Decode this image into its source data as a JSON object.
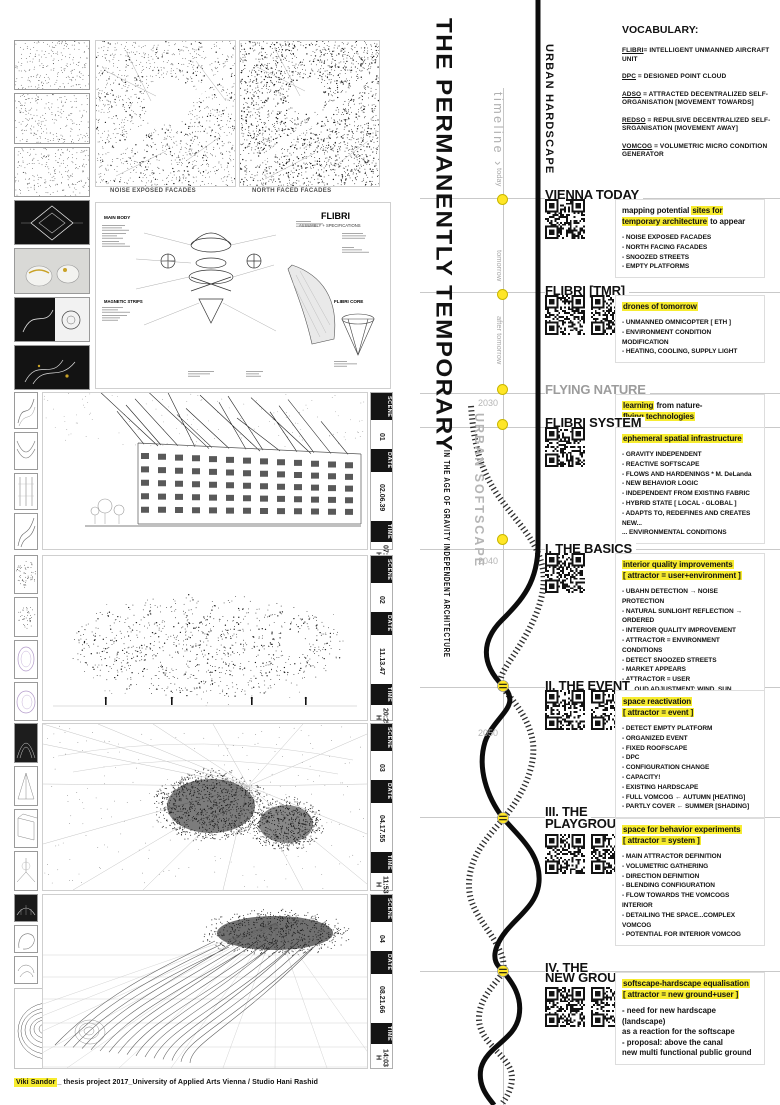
{
  "title": {
    "main": "THE PERMANENTLY TEMPORARY",
    "subtitle": "IN THE AGE OF GRAVITY INDEPENDENT ARCHITECTURE"
  },
  "timeline": {
    "label": "timeline",
    "arrow": "›",
    "hardscape": "URBAN HARDSCAPE",
    "softscape": "URBAN SOFTSCAPE",
    "tick_today": "today",
    "tick_tomorrow": "tomorrow",
    "tick_after": "after tomorrow",
    "year_2030": "2030",
    "year_2040": "2040",
    "year_2050": "2050"
  },
  "vocabulary": {
    "heading": "VOCABULARY:",
    "entries": [
      {
        "term": "FLIBRI",
        "def": "= INTELLIGENT UNMANNED AIRCRAFT UNIT"
      },
      {
        "term": "DPC",
        "def": " = DESIGNED POINT CLOUD"
      },
      {
        "term": "ADSO",
        "def": " = ATTRACTED DECENTRALIZED SELF-ORGANISATION [MOVEMENT TOWARDS]"
      },
      {
        "term": "REDSO",
        "def": " = REPULSIVE DECENTRALIZED SELF-SRGANISATION [MOVEMENT AWAY]"
      },
      {
        "term": "VOMCOG",
        "def": " = VOLUMETRIC MICRO CONDITION GENERATOR"
      }
    ]
  },
  "maps": {
    "label_left": "NOISE EXPOSED FACADES",
    "label_right": "NORTH FACED FACADES"
  },
  "flibri_diagram": {
    "title": "FLIBRI",
    "subtitle": "ASSEMBLY + SPECIFICATIONS",
    "label_main_body": "MAIN BODY",
    "label_magnetic": "MAGNETIC STRIPS",
    "label_core": "FLIBRI CORE"
  },
  "scenes": [
    {
      "scene_label": "SCENE",
      "scene": "01",
      "date_label": "DATE",
      "date": "02.06.39",
      "time_label": "TIME",
      "time": "07:10 H"
    },
    {
      "scene_label": "SCENE",
      "scene": "02",
      "date_label": "DATE",
      "date": "11.13.47",
      "time_label": "TIME",
      "time": "20:25 H"
    },
    {
      "scene_label": "SCENE",
      "scene": "03",
      "date_label": "DATE",
      "date": "04.17.55",
      "time_label": "TIME",
      "time": "11:53 H"
    },
    {
      "scene_label": "SCENE",
      "scene": "04",
      "date_label": "DATE",
      "date": "08.21.66",
      "time_label": "TIME",
      "time": "14:03 H"
    }
  ],
  "sections": [
    {
      "heading": "VIENNA TODAY",
      "qr_count": 1,
      "intro": [
        [
          {
            "t": "mapping potential ",
            "h": 0
          },
          {
            "t": "sites for temporary architecture",
            "h": 1
          },
          {
            "t": " to appear",
            "h": 0
          }
        ]
      ],
      "bullets": [
        "- NOISE EXPOSED FACADES",
        "- NORTH FACING FACADES",
        "- SNOOZED STREETS",
        "- EMPTY PLATFORMS"
      ]
    },
    {
      "heading": "FLIBRI [TMR]",
      "qr_count": 2,
      "intro": [
        [
          {
            "t": "drones of tomorrow",
            "h": 1
          }
        ]
      ],
      "bullets": [
        "- UNMANNED OMNICOPTER [ ETH ]",
        "- ENVIRONMENT CONDITION MODIFICATION",
        "- HEATING, COOLING, SUPPLY LIGHT"
      ]
    },
    {
      "heading": "FLYING NATURE",
      "gray": true,
      "qr_count": 0,
      "intro": [
        [
          {
            "t": "learning",
            "h": 1
          },
          {
            "t": " from nature-",
            "h": 0
          }
        ],
        [
          {
            "t": "flying technologies",
            "h": 1
          }
        ]
      ],
      "bullets": []
    },
    {
      "heading": "FLIBRI SYSTEM",
      "qr_count": 1,
      "intro": [
        [
          {
            "t": "ephemeral spatial infrastructure",
            "h": 1
          }
        ]
      ],
      "bullets": [
        "- GRAVITY INDEPENDENT",
        "- REACTIVE SOFTSCAPE",
        "- FLOWS AND HARDENINGS * M. DeLanda",
        "- NEW BEHAVIOR LOGIC",
        "- INDEPENDENT FROM EXISTING FABRIC",
        "- HYBRID STATE [ LOCAL - GLOBAL ]",
        "- ADAPTS TO, REDEFINES AND CREATES NEW...",
        "... ENVIRONMENTAL CONDITIONS"
      ]
    },
    {
      "heading": "I. THE BASICS",
      "qr_count": 1,
      "intro": [
        [
          {
            "t": "interior quality improvements",
            "h": 1
          }
        ],
        [
          {
            "t": "[ attractor = user+environment ]",
            "h": 1
          }
        ]
      ],
      "bullets": [
        "- UBAHN DETECTION → NOISE PROTECTION",
        "- NATURAL SUNLIGHT REFLECTION → ORDERED",
        "- INTERIOR QUALITY IMPROVEMENT",
        "- ATTRACTOR = ENVIRONMENT CONDITIONS",
        "- DETECT SNOOZED STREETS",
        "- MARKET APPEARS",
        "- ATTRACTOR = USER",
        "- CLOUD ADJUSTMENT: WIND, SUN"
      ]
    },
    {
      "heading": "II. THE EVENT",
      "qr_count": 2,
      "intro": [
        [
          {
            "t": "space reactivation",
            "h": 1
          }
        ],
        [
          {
            "t": "[ attractor = event ]",
            "h": 1
          }
        ]
      ],
      "bullets": [
        "- DETECT EMPTY PLATFORM",
        "- ORGANIZED EVENT",
        "- FIXED ROOFSCAPE",
        "- DPC",
        "- CONFIGURATION CHANGE",
        "- CAPACITY!",
        "- EXISTING HARDSCAPE",
        "- FULL VOMCOG ← AUTUMN [HEATING]",
        "- PARTLY COVER ← SUMMER [SHADING]"
      ]
    },
    {
      "heading": "III. THE",
      "heading2": "PLAYGROUND",
      "qr_count": 2,
      "intro": [
        [
          {
            "t": "space for behavior experiments",
            "h": 1
          }
        ],
        [
          {
            "t": "[ attractor = system ]",
            "h": 1
          }
        ]
      ],
      "bullets": [
        "- MAIN ATTRACTOR DEFINITION",
        "- VOLUMETRIC GATHERING",
        "- DIRECTION DEFINITION",
        "- BLENDING CONFIGURATION",
        "- FLOW TOWARDS THE VOMCOGS INTERIOR",
        "- DETAILING THE SPACE...COMPLEX VOMCOG",
        "- POTENTIAL FOR INTERIOR VOMCOG"
      ]
    },
    {
      "heading": "IV. THE",
      "heading2": "NEW GROUND",
      "qr_count": 2,
      "intro": [
        [
          {
            "t": "softscape-hardscape equalisation",
            "h": 1
          }
        ],
        [
          {
            "t": "[ attractor = new ground+user ]",
            "h": 1
          }
        ]
      ],
      "bullets": [],
      "paragraph": [
        "- need for new hardscape (landscape)",
        "as a reaction for the softscape",
        "- proposal: above the canal",
        "new multi functional public ground"
      ]
    }
  ],
  "credit": {
    "name": "Viki Sandor",
    "rest": "_ thesis project 2017_University of Applied Arts Vienna / Studio Hani Rashid"
  },
  "colors": {
    "highlight": "#f7ec2f",
    "marker_yellow": "#ffe627",
    "accent_gold": "#c9a227"
  }
}
